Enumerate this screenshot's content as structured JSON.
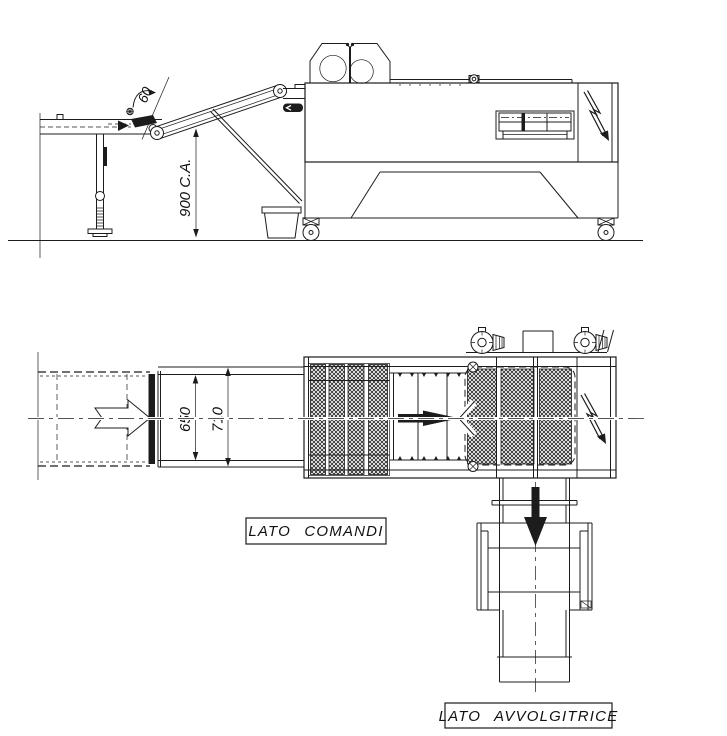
{
  "drawing": {
    "colors": {
      "ink": "#1c1c1c",
      "paper": "#ffffff"
    },
    "side_view": {
      "angle_dim": "60",
      "height_dim": "900 C.A."
    },
    "plan_view": {
      "inner_width_dim": "650",
      "outer_width_dim": "710",
      "control_side_label": "LATO COMANDI",
      "winder_side_label": "LATO AVVOLGITRICE"
    },
    "icons": {
      "electric_hazard": "lightning-bolt",
      "product_flow": "arrow"
    }
  }
}
